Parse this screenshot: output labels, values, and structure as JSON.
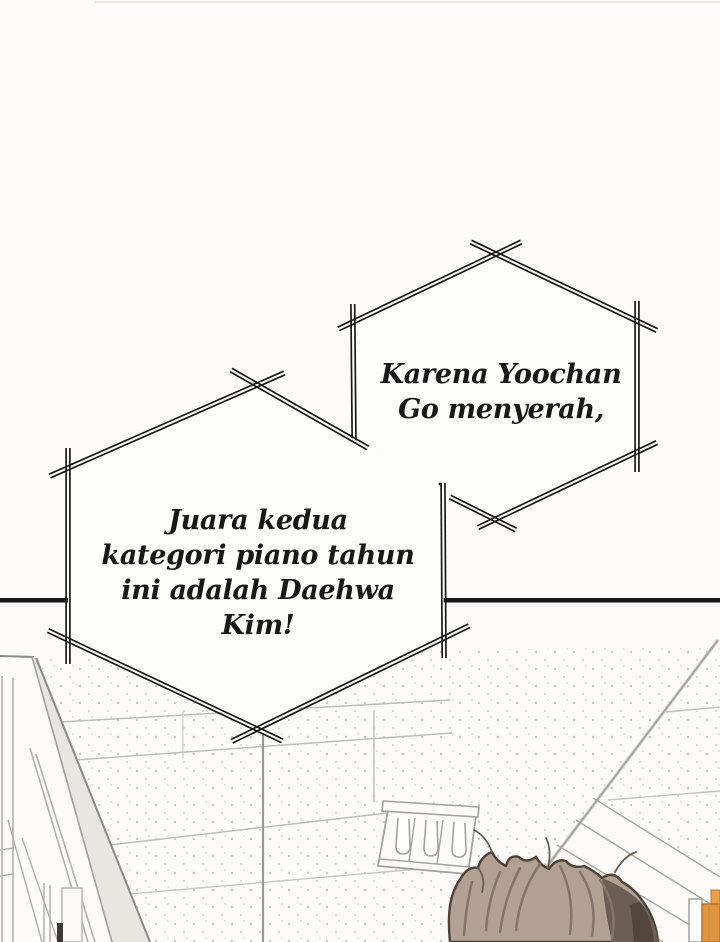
{
  "comic_page": {
    "panel_count": 2,
    "speech_bubbles": [
      {
        "name": "announcement-bubble-1",
        "shape": "spiked-hexagon",
        "lines": [
          "Karena Yoochan",
          "Go menyerah,"
        ]
      },
      {
        "name": "announcement-bubble-2",
        "shape": "spiked-hexagon",
        "lines": [
          "Juara kedua",
          "kategori piano tahun",
          "ini adalah Daehwa",
          "Kim!"
        ]
      }
    ],
    "colors": {
      "ink": "#1a1a1a",
      "panel_divider": "#141414",
      "bubble_fill": "#fdfdfc",
      "scene_line_dark": "#8e8a85",
      "scene_line_light": "#b3afaa",
      "ceiling_seam": "#c0bcb7",
      "ceiling_dot": "#ccc8c3",
      "hair_base": "#b2a193",
      "hair_strand": "#84756a",
      "hair_dark_side": "#6b5e55",
      "hair_outline": "#4e4237",
      "door_orange": "#df9440"
    }
  }
}
